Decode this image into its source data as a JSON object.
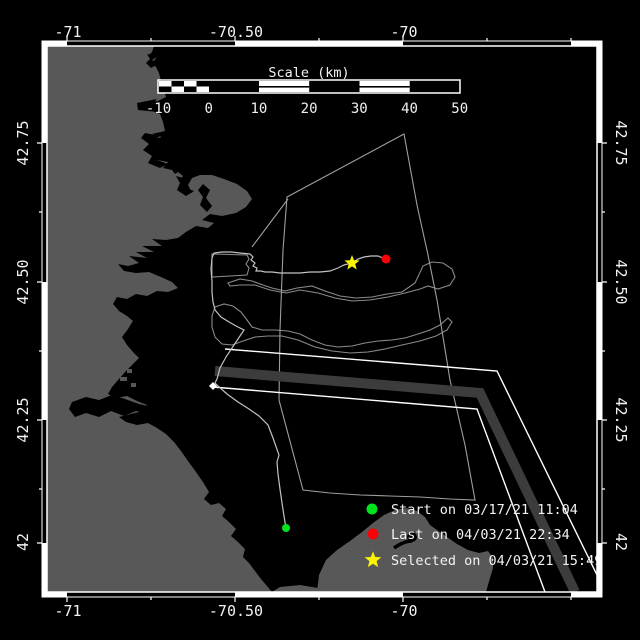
{
  "map": {
    "lon_labels": [
      "-71",
      "-70.50",
      "-70"
    ],
    "lat_labels": [
      "42.75",
      "42.50",
      "42.25",
      "42"
    ],
    "scale_bar": {
      "title": "Scale (km)",
      "tick_labels": [
        "-10",
        "0",
        "10",
        "20",
        "30",
        "40",
        "50"
      ]
    },
    "legend": {
      "items": [
        {
          "marker": "circle",
          "color": "#00e41e",
          "label": "Start on 03/17/21 11:04"
        },
        {
          "marker": "circle",
          "color": "#fa0007",
          "label": "Last on 04/03/21 22:34"
        },
        {
          "marker": "star",
          "color": "#fdf500",
          "label": "Selected on 04/03/21 15:49"
        }
      ]
    },
    "colors": {
      "water": "#000000",
      "land": "#585858",
      "lane_zone": "#3c3c3c",
      "lane_boundary": "#ffffff",
      "track": "#c2c2c2",
      "contour": "#8a8a8a",
      "polygon": "#9e9e9e",
      "frame": "#ffffff"
    }
  }
}
